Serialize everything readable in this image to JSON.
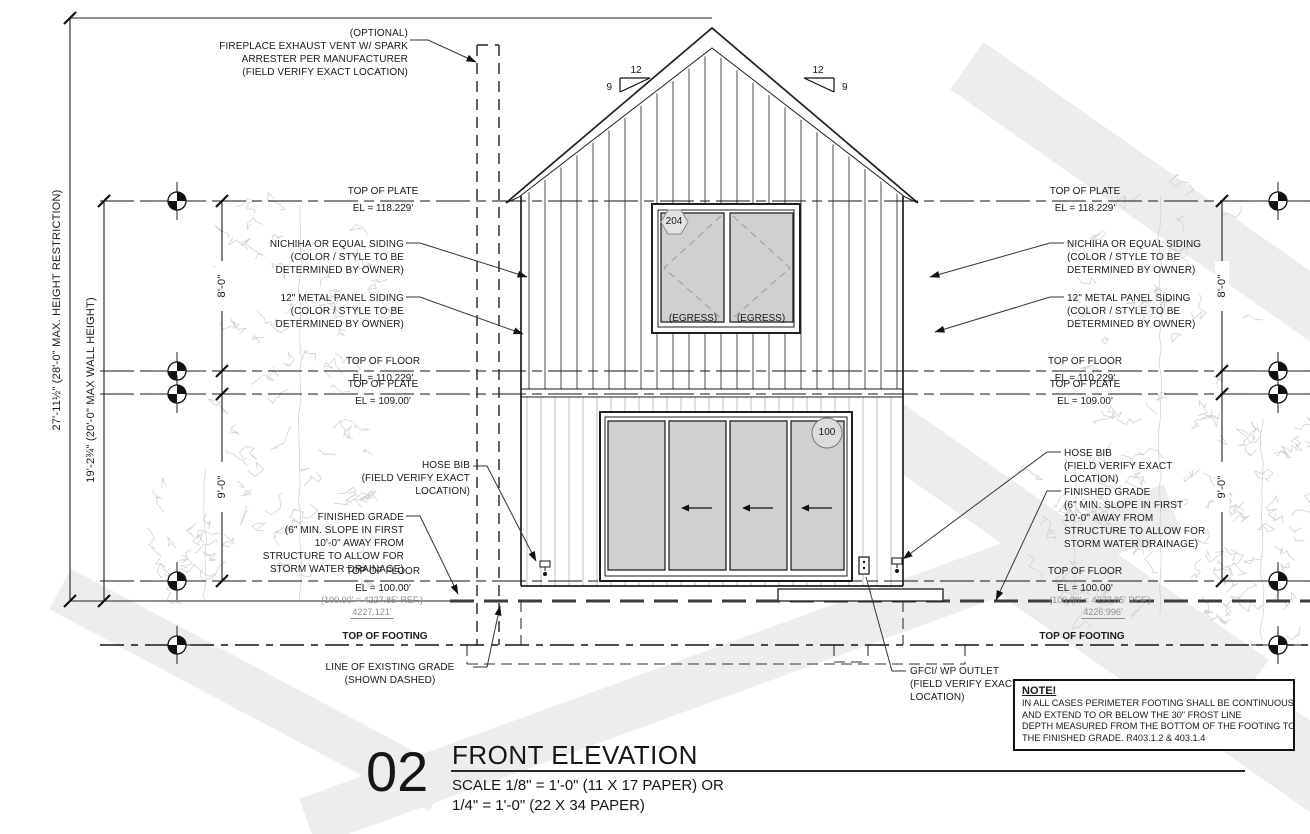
{
  "title_block": {
    "number": "02",
    "title": "FRONT ELEVATION",
    "scale_line1": "SCALE 1/8\" = 1'-0\" (11 X 17 PAPER) OR",
    "scale_line2": "1/4\" = 1'-0\" (22 X 34 PAPER)"
  },
  "levels": [
    {
      "label": "TOP OF PLATE",
      "elevation": "EL = 118.229'"
    },
    {
      "label": "TOP OF FLOOR",
      "elevation": "EL = 110.229'"
    },
    {
      "label": "TOP OF PLATE",
      "elevation": "EL = 109.00'"
    },
    {
      "label": "TOP OF FLOOR",
      "elevation": "EL = 100.00'",
      "reference": "(100.00' = 4227.85' REF.)",
      "left_spot_elevation": "4227.121'",
      "right_spot_elevation": "4226.996'"
    },
    {
      "label": "TOP OF FOOTING"
    }
  ],
  "dimensions": {
    "overall_height": "27'-11½\" (28'-0\" MAX. HEIGHT RESTRICTION)",
    "wall_height": "19'-2¾\" (20'-0\" MAX WALL HEIGHT)",
    "upper_floor": "8'-0\"",
    "lower_floor": "9'-0\""
  },
  "roof_pitch": {
    "run": "12",
    "rise": "9"
  },
  "tags": {
    "window": "204",
    "door": "100",
    "egress": "(EGRESS)"
  },
  "callouts": {
    "fireplace": [
      "(OPTIONAL)",
      "FIREPLACE EXHAUST VENT W/ SPARK",
      "ARRESTER PER MANUFACTURER",
      "(FIELD VERIFY EXACT LOCATION)"
    ],
    "nichiha": [
      "NICHIHA OR EQUAL SIDING",
      "(COLOR / STYLE TO BE",
      "DETERMINED BY OWNER)"
    ],
    "metal": [
      "12\" METAL PANEL SIDING",
      "(COLOR / STYLE TO BE",
      "DETERMINED BY OWNER)"
    ],
    "hose_bib": [
      "HOSE BIB",
      "(FIELD VERIFY EXACT",
      "LOCATION)"
    ],
    "finished_grade": [
      "FINISHED GRADE",
      "(6\" MIN. SLOPE IN FIRST",
      "10'-0\" AWAY FROM",
      "STRUCTURE TO ALLOW FOR",
      "STORM WATER DRAINAGE)"
    ],
    "existing_grade": [
      "LINE OF EXISTING GRADE",
      "(SHOWN DASHED)"
    ],
    "gfci": [
      "GFCI/ WP OUTLET",
      "(FIELD VERIFY EXACT",
      "LOCATION)"
    ]
  },
  "note": {
    "heading": "NOTE!",
    "body": [
      "IN ALL CASES PERIMETER FOOTING SHALL BE CONTINUOUS",
      "AND EXTEND TO OR BELOW THE 30\" FROST LINE",
      "DEPTH MEASURED FROM THE BOTTOM OF THE FOOTING TO",
      "THE FINISHED GRADE. R403.1.2 & 403.1.4"
    ]
  },
  "colors": {
    "ink": "#1a1a1a",
    "muted": "#8f8f8f",
    "panel_fill": "#d0d0d0",
    "watermark": "#ededed"
  }
}
